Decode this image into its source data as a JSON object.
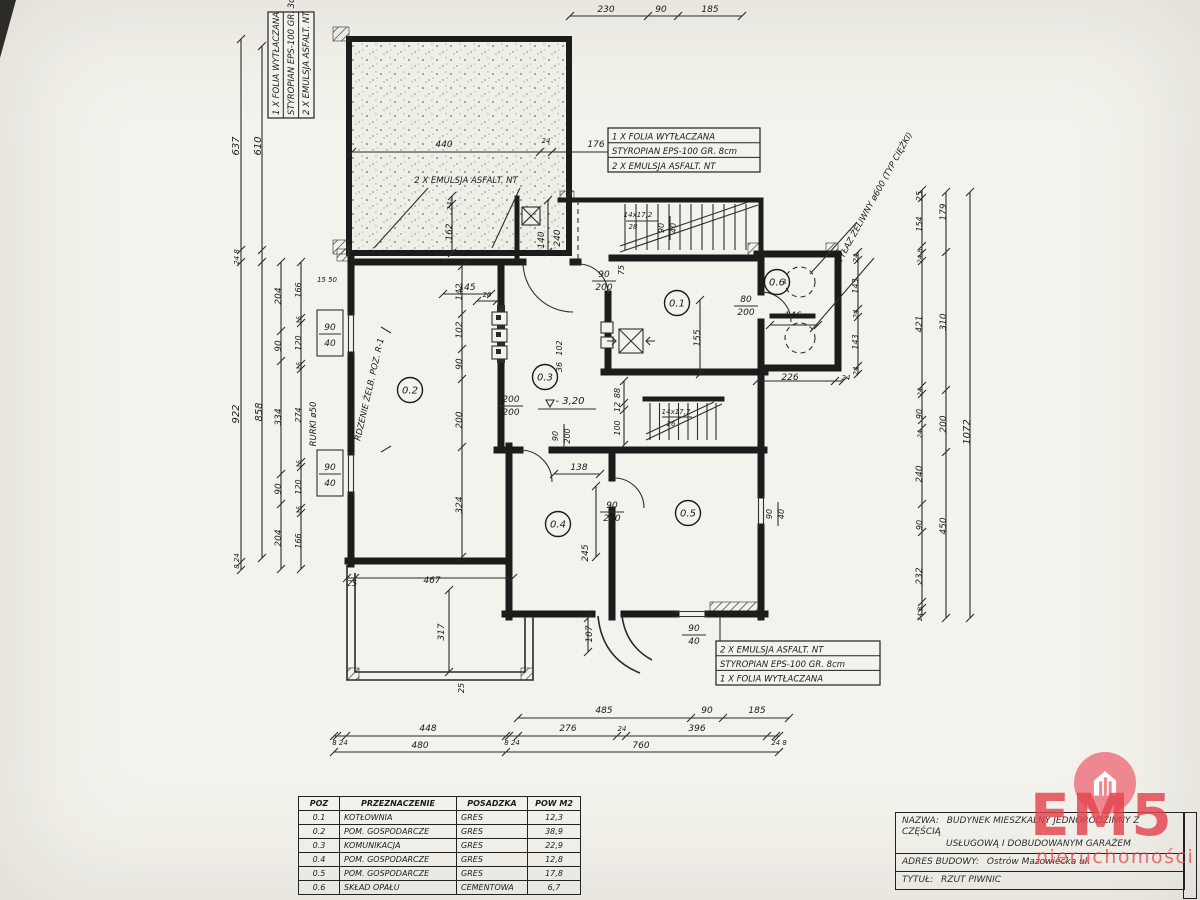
{
  "notes": {
    "top_left": [
      "1 X FOLIA WYTŁACZANA",
      "STYROPIAN EPS-100 GR. 3cm",
      "2 X EMULSJA ASFALT. NT"
    ],
    "top_mid": [
      "1 X FOLIA WYTŁACZANA",
      "STYROPIAN EPS-100 GR. 8cm",
      "2 X EMULSJA ASFALT. NT"
    ],
    "bottom": [
      "2 X EMULSJA ASFALT. NT",
      "STYROPIAN EPS-100 GR. 8cm",
      "1 X FOLIA WYTŁACZANA"
    ]
  },
  "room_table": {
    "headers": [
      "POZ",
      "PRZEZNACZENIE",
      "POSADZKA",
      "POW M2"
    ],
    "rows": [
      [
        "0.1",
        "KOTŁOWNIA",
        "GRES",
        "12,3"
      ],
      [
        "0.2",
        "POM. GOSPODARCZE",
        "GRES",
        "38,9"
      ],
      [
        "0.3",
        "KOMUNIKACJA",
        "GRES",
        "22,9"
      ],
      [
        "0.4",
        "POM. GOSPODARCZE",
        "GRES",
        "12,8"
      ],
      [
        "0.5",
        "POM. GOSPODARCZE",
        "GRES",
        "17,8"
      ],
      [
        "0.6",
        "SKŁAD OPAŁU",
        "CEMENTOWA",
        "6,7"
      ]
    ]
  },
  "title_block": {
    "nazwa_label": "NAZWA:",
    "nazwa_line1": "BUDYNEK MIESZKALNY JEDNORODZINNY Z CZĘŚCIĄ",
    "nazwa_line2": "USŁUGOWĄ I DOBUDOWANYM GARAŻEM",
    "adres_label": "ADRES BUDOWY:",
    "adres_value": "Ostrów Mazowiecka ul.",
    "tytul_label": "TYTUŁ:",
    "tytul_value": "RZUT PIWNIC"
  },
  "watermark": {
    "brand": "EM5",
    "subtitle": "nieruchomości",
    "color": "#e4444e"
  },
  "rooms": [
    {
      "id": "0.1",
      "x": 677,
      "y": 303
    },
    {
      "id": "0.2",
      "x": 410,
      "y": 390
    },
    {
      "id": "0.3",
      "x": 545,
      "y": 377
    },
    {
      "id": "0.4",
      "x": 558,
      "y": 524
    },
    {
      "id": "0.5",
      "x": 688,
      "y": 513
    },
    {
      "id": "0.6",
      "x": 777,
      "y": 282
    }
  ],
  "plan_labels": [
    {
      "x": 606,
      "y": 12,
      "t": "230"
    },
    {
      "x": 661,
      "y": 12,
      "t": "90"
    },
    {
      "x": 710,
      "y": 12,
      "t": "185"
    },
    {
      "x": 444,
      "y": 147,
      "t": "440"
    },
    {
      "x": 546,
      "y": 143,
      "t": "24",
      "fs": 7
    },
    {
      "x": 596,
      "y": 147,
      "t": "176"
    },
    {
      "x": 466,
      "y": 183,
      "t": "2 X EMULSJA ASFALT. NT",
      "fs": 8.5,
      "n": "garage-note"
    },
    {
      "x": 452,
      "y": 206,
      "t": "24",
      "r": -90,
      "fs": 7
    },
    {
      "x": 452,
      "y": 232,
      "t": "162",
      "r": -90
    },
    {
      "x": 544,
      "y": 240,
      "t": "140",
      "r": -90
    },
    {
      "x": 560,
      "y": 238,
      "t": "240",
      "r": -90
    },
    {
      "x": 239,
      "y": 146,
      "t": "637",
      "r": -90,
      "fs": 10
    },
    {
      "x": 261,
      "y": 146,
      "t": "610",
      "r": -90,
      "fs": 10
    },
    {
      "x": 239,
      "y": 257,
      "t": "24 8",
      "r": -90,
      "fs": 7
    },
    {
      "x": 239,
      "y": 414,
      "t": "922",
      "r": -90,
      "fs": 10
    },
    {
      "x": 239,
      "y": 561,
      "t": "8 24",
      "r": -90,
      "fs": 7
    },
    {
      "x": 262,
      "y": 412,
      "t": "858",
      "r": -90,
      "fs": 10
    },
    {
      "x": 281,
      "y": 296,
      "t": "204",
      "r": -90
    },
    {
      "x": 281,
      "y": 346,
      "t": "90",
      "r": -90
    },
    {
      "x": 281,
      "y": 417,
      "t": "334",
      "r": -90
    },
    {
      "x": 281,
      "y": 489,
      "t": "90",
      "r": -90
    },
    {
      "x": 281,
      "y": 538,
      "t": "204",
      "r": -90
    },
    {
      "x": 301,
      "y": 290,
      "t": "166",
      "r": -90,
      "fs": 8
    },
    {
      "x": 301,
      "y": 320,
      "t": "15",
      "r": -90,
      "fs": 6.5
    },
    {
      "x": 301,
      "y": 343,
      "t": "120",
      "r": -90,
      "fs": 8
    },
    {
      "x": 301,
      "y": 366,
      "t": "15",
      "r": -90,
      "fs": 6.5
    },
    {
      "x": 301,
      "y": 415,
      "t": "274",
      "r": -90,
      "fs": 8
    },
    {
      "x": 301,
      "y": 464,
      "t": "15",
      "r": -90,
      "fs": 6.5
    },
    {
      "x": 301,
      "y": 487,
      "t": "120",
      "r": -90,
      "fs": 8
    },
    {
      "x": 301,
      "y": 510,
      "t": "15",
      "r": -90,
      "fs": 6.5
    },
    {
      "x": 301,
      "y": 541,
      "t": "166",
      "r": -90,
      "fs": 8
    },
    {
      "x": 316,
      "y": 424,
      "t": "RURKI ø50",
      "r": -90,
      "fs": 8.5,
      "n": "rurki-label"
    },
    {
      "x": 327,
      "y": 282,
      "t": "15 50",
      "fs": 7
    },
    {
      "x": 330,
      "y": 330,
      "t": "90"
    },
    {
      "x": 330,
      "y": 346,
      "t": "40"
    },
    {
      "x": 330,
      "y": 470,
      "t": "90"
    },
    {
      "x": 330,
      "y": 486,
      "t": "40"
    },
    {
      "x": 372,
      "y": 390,
      "t": "RDZENIE ŻELB. POZ. R-1",
      "r": -77,
      "fs": 8.5,
      "n": "rdzenie-label"
    },
    {
      "x": 462,
      "y": 292,
      "t": "142",
      "r": -90
    },
    {
      "x": 462,
      "y": 330,
      "t": "102",
      "r": -90
    },
    {
      "x": 462,
      "y": 364,
      "t": "90",
      "r": -90
    },
    {
      "x": 462,
      "y": 420,
      "t": "200",
      "r": -90
    },
    {
      "x": 462,
      "y": 505,
      "t": "324",
      "r": -90
    },
    {
      "x": 487,
      "y": 297,
      "t": "20",
      "fs": 7
    },
    {
      "x": 467,
      "y": 290,
      "t": "145"
    },
    {
      "x": 562,
      "y": 348,
      "t": "102",
      "r": -90,
      "fs": 8
    },
    {
      "x": 562,
      "y": 367,
      "t": "36",
      "r": -90,
      "fs": 8
    },
    {
      "x": 511,
      "y": 402,
      "t": "200"
    },
    {
      "x": 511,
      "y": 415,
      "t": "200"
    },
    {
      "x": 570,
      "y": 404,
      "t": "- 3,20",
      "fs": 10,
      "n": "level-label"
    },
    {
      "x": 604,
      "y": 277,
      "t": "90"
    },
    {
      "x": 604,
      "y": 290,
      "t": "200"
    },
    {
      "x": 624,
      "y": 270,
      "t": "75",
      "r": -90,
      "fs": 8
    },
    {
      "x": 620,
      "y": 393,
      "t": "88",
      "r": -90,
      "fs": 8
    },
    {
      "x": 620,
      "y": 407,
      "t": "12",
      "r": -90,
      "fs": 8
    },
    {
      "x": 620,
      "y": 428,
      "t": "100",
      "r": -90,
      "fs": 8
    },
    {
      "x": 638,
      "y": 217,
      "t": "14x17,2",
      "fs": 7
    },
    {
      "x": 633,
      "y": 229,
      "t": "28",
      "fs": 7
    },
    {
      "x": 664,
      "y": 228,
      "t": "90",
      "r": -90,
      "fs": 8
    },
    {
      "x": 676,
      "y": 228,
      "t": "40",
      "r": -90,
      "fs": 8
    },
    {
      "x": 700,
      "y": 338,
      "t": "155",
      "r": -90
    },
    {
      "x": 746,
      "y": 302,
      "t": "80"
    },
    {
      "x": 746,
      "y": 315,
      "t": "200"
    },
    {
      "x": 793,
      "y": 318,
      "t": "146"
    },
    {
      "x": 790,
      "y": 380,
      "t": "226"
    },
    {
      "x": 846,
      "y": 380,
      "t": "24",
      "fs": 7
    },
    {
      "x": 858,
      "y": 258,
      "t": "24",
      "r": -90,
      "fs": 7
    },
    {
      "x": 858,
      "y": 286,
      "t": "143",
      "r": -90,
      "fs": 8
    },
    {
      "x": 858,
      "y": 314,
      "t": "24",
      "r": -90,
      "fs": 7
    },
    {
      "x": 858,
      "y": 342,
      "t": "143",
      "r": -90,
      "fs": 8
    },
    {
      "x": 858,
      "y": 371,
      "t": "24",
      "r": -90,
      "fs": 7
    },
    {
      "x": 876,
      "y": 200,
      "t": "WYŁAZ ŻELIWNY ø600 (TYP CIĘŻKI)",
      "r": -61,
      "fs": 8.5,
      "n": "wylaz-label"
    },
    {
      "x": 922,
      "y": 196,
      "t": "25",
      "r": -90,
      "fs": 8
    },
    {
      "x": 922,
      "y": 224,
      "t": "154",
      "r": -90,
      "fs": 8
    },
    {
      "x": 922,
      "y": 256,
      "t": "24 8",
      "r": -90,
      "fs": 6.5
    },
    {
      "x": 922,
      "y": 324,
      "t": "421",
      "r": -90
    },
    {
      "x": 922,
      "y": 392,
      "t": "24",
      "r": -90,
      "fs": 6.5
    },
    {
      "x": 922,
      "y": 414,
      "t": "90",
      "r": -90,
      "fs": 8
    },
    {
      "x": 922,
      "y": 434,
      "t": "24",
      "r": -90,
      "fs": 6.5
    },
    {
      "x": 922,
      "y": 474,
      "t": "240",
      "r": -90
    },
    {
      "x": 922,
      "y": 525,
      "t": "90",
      "r": -90,
      "fs": 8
    },
    {
      "x": 922,
      "y": 576,
      "t": "232",
      "r": -90
    },
    {
      "x": 922,
      "y": 614,
      "t": "24 8",
      "r": -90,
      "fs": 6.5
    },
    {
      "x": 946,
      "y": 212,
      "t": "179",
      "r": -90
    },
    {
      "x": 946,
      "y": 322,
      "t": "310",
      "r": -90
    },
    {
      "x": 946,
      "y": 424,
      "t": "200",
      "r": -90
    },
    {
      "x": 946,
      "y": 526,
      "t": "450",
      "r": -90
    },
    {
      "x": 970,
      "y": 432,
      "t": "1072",
      "r": -90,
      "fs": 10
    },
    {
      "x": 558,
      "y": 436,
      "t": "90",
      "r": -90,
      "fs": 8
    },
    {
      "x": 570,
      "y": 436,
      "t": "200",
      "r": -90,
      "fs": 8
    },
    {
      "x": 579,
      "y": 470,
      "t": "138"
    },
    {
      "x": 612,
      "y": 508,
      "t": "90"
    },
    {
      "x": 612,
      "y": 521,
      "t": "200"
    },
    {
      "x": 588,
      "y": 553,
      "t": "245",
      "r": -90
    },
    {
      "x": 592,
      "y": 634,
      "t": "107",
      "r": -90
    },
    {
      "x": 694,
      "y": 631,
      "t": "90"
    },
    {
      "x": 694,
      "y": 644,
      "t": "40"
    },
    {
      "x": 772,
      "y": 514,
      "t": "90",
      "r": -90,
      "fs": 8
    },
    {
      "x": 784,
      "y": 514,
      "t": "40",
      "r": -90,
      "fs": 8
    },
    {
      "x": 676,
      "y": 414,
      "t": "14x17,7",
      "fs": 7
    },
    {
      "x": 671,
      "y": 426,
      "t": "26",
      "fs": 7
    },
    {
      "x": 352,
      "y": 586,
      "t": "25",
      "fs": 8
    },
    {
      "x": 432,
      "y": 583,
      "t": "467"
    },
    {
      "x": 444,
      "y": 632,
      "t": "317",
      "r": -90
    },
    {
      "x": 464,
      "y": 688,
      "t": "25",
      "r": -90,
      "fs": 8
    },
    {
      "x": 604,
      "y": 713,
      "t": "485"
    },
    {
      "x": 707,
      "y": 713,
      "t": "90"
    },
    {
      "x": 757,
      "y": 713,
      "t": "185"
    },
    {
      "x": 340,
      "y": 745,
      "t": "8 24",
      "fs": 7
    },
    {
      "x": 428,
      "y": 731,
      "t": "448"
    },
    {
      "x": 512,
      "y": 745,
      "t": "8 24",
      "fs": 7
    },
    {
      "x": 568,
      "y": 731,
      "t": "276"
    },
    {
      "x": 622,
      "y": 731,
      "t": "24",
      "fs": 7
    },
    {
      "x": 697,
      "y": 731,
      "t": "396"
    },
    {
      "x": 779,
      "y": 745,
      "t": "24 8",
      "fs": 7
    },
    {
      "x": 420,
      "y": 748,
      "t": "480"
    },
    {
      "x": 641,
      "y": 748,
      "t": "760"
    }
  ]
}
